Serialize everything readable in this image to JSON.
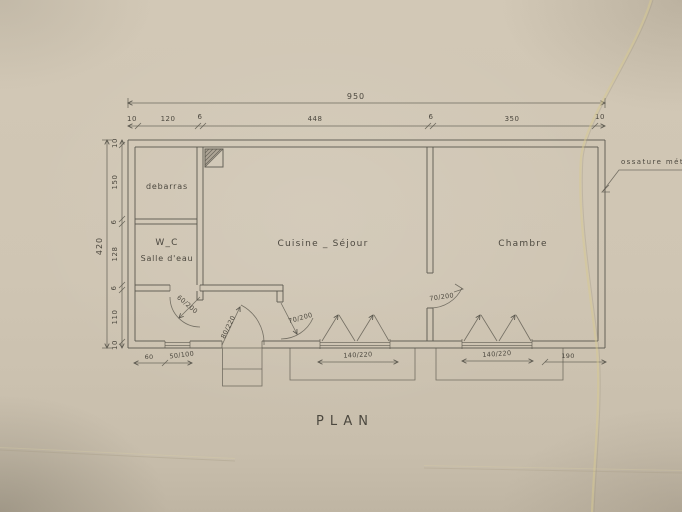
{
  "title": "PLAN",
  "annotation": "ossature  mét",
  "rooms": {
    "debarras": "debarras",
    "wc_line1": "W_C",
    "wc_line2": "Salle d'eau",
    "living": "Cuisine _ Séjour",
    "bedroom": "Chambre"
  },
  "dims": {
    "top_total": "950",
    "top_segments": [
      "10",
      "120",
      "6",
      "448",
      "6",
      "350",
      "10"
    ],
    "left_total": "420",
    "left_segments": [
      "10",
      "150",
      "6",
      "128",
      "6",
      "110",
      "10"
    ],
    "bottom_left_wall": "60",
    "bottom_small_window": "50/100",
    "bottom_window1": "140/220",
    "bottom_window2": "140/220",
    "bottom_right": "190",
    "door_wc": "60/200",
    "door_entry": "80/220",
    "door_kitchen": "70/200",
    "door_bedroom": "70/200"
  },
  "colors": {
    "paper": "#cfc5b3",
    "line": "#57544b",
    "ink": "#4c483f",
    "crease": "#d6c78f"
  }
}
